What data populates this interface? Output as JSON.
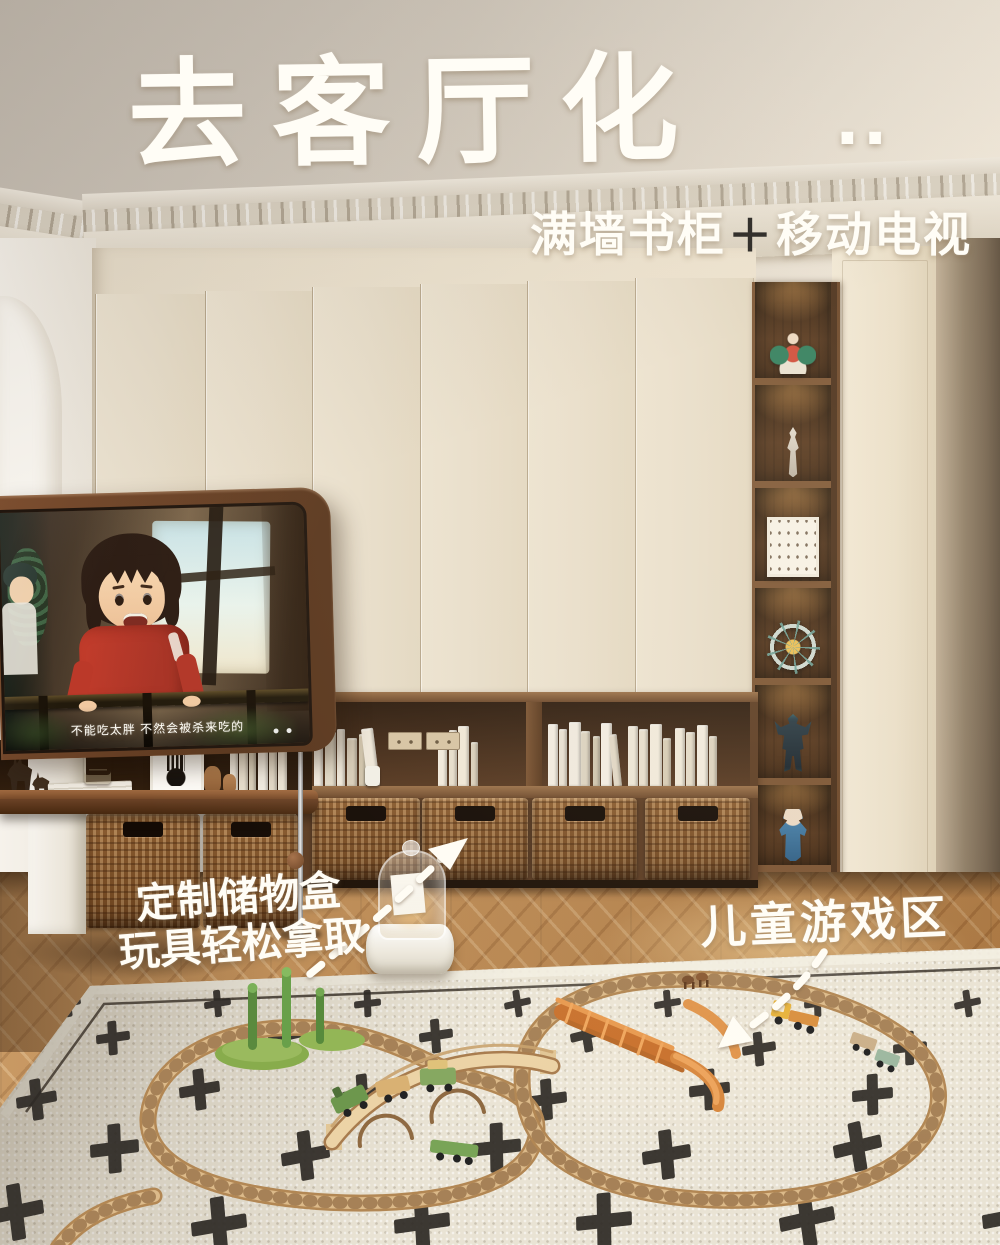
{
  "post": {
    "title": "去客厅化",
    "title_dots": "..",
    "subtitle_parts": {
      "left": "满墙书柜",
      "plus": "＋",
      "right": "移动电视"
    },
    "annotations": {
      "storage_line1": "定制储物盒",
      "storage_line2": "玩具轻松拿取",
      "play_area": "儿童游戏区"
    }
  },
  "tv": {
    "subtitle_caption": "不能吃太胖 不然会被杀来吃的"
  },
  "display_shelf_items": [
    "anime-figurine",
    "white-figurine",
    "framed-print",
    "ferris-wheel-model",
    "mecha-figure",
    "blue-doll"
  ],
  "colors": {
    "cabinet_cream": "#e9dfcc",
    "walnut": "#6b432a",
    "rug_base": "#e9e3d4",
    "rug_cross": "#2e2a25",
    "wicker": "#8a5e3b",
    "bridge_orange": "#d0823a",
    "track_wood": "#dcba8a",
    "overlay_text": "#fffdf6"
  }
}
